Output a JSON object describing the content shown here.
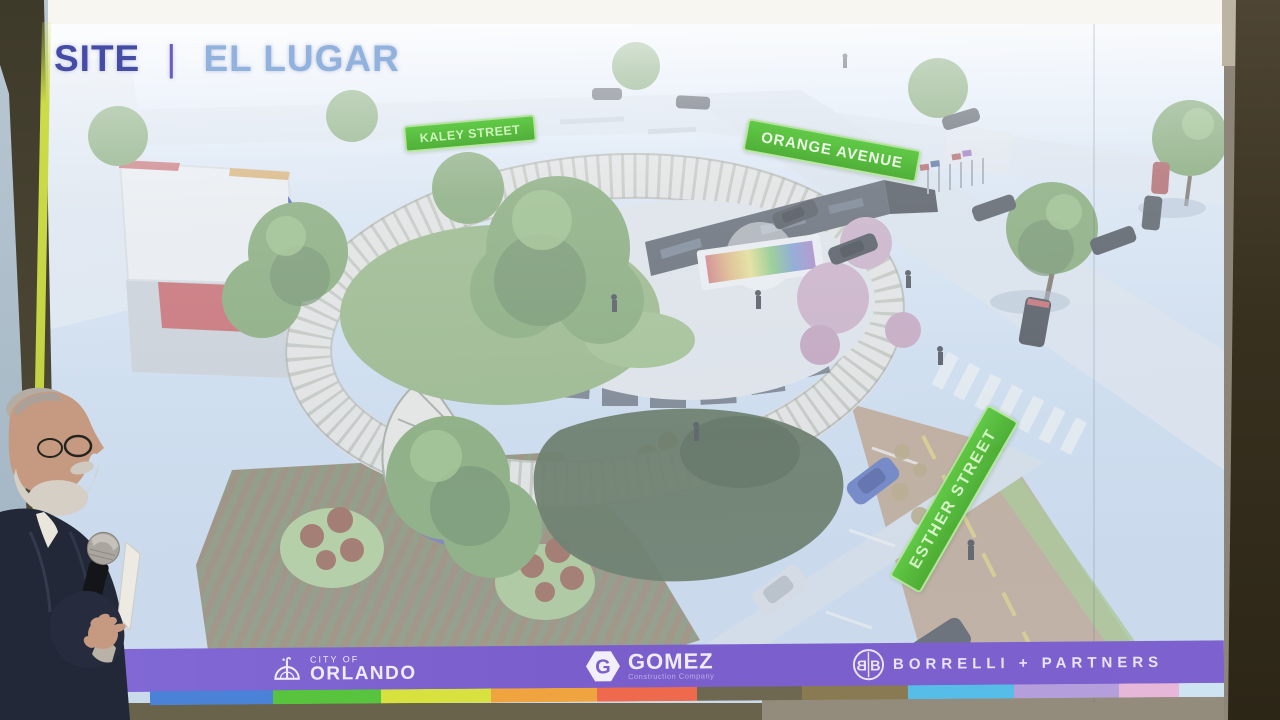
{
  "slide": {
    "title": {
      "section": "SITE",
      "separator": "|",
      "name": "EL LUGAR"
    },
    "street_labels": {
      "kaley": "KALEY STREET",
      "orange": "ORANGE AVENUE",
      "esther": "ESTHER STREET"
    },
    "footer": {
      "orlando_line1": "CITY OF",
      "orlando_line2": "ORLANDO",
      "gomez_initial": "G",
      "gomez_name": "GOMEZ",
      "gomez_tagline": "Construction Company",
      "borrelli_name": "BORRELLI + PARTNERS",
      "bar_color": "#7b5fd0"
    },
    "colors": {
      "street_label_green": "#54c23a",
      "title_site_blue": "#454ca6",
      "title_name_blue": "#90b2dd",
      "screen_edge_strip": "#c3d544"
    },
    "rainbow_segments": [
      {
        "color": "#4a82d8",
        "width": 123
      },
      {
        "color": "#58c43e",
        "width": 108
      },
      {
        "color": "#d8e23e",
        "width": 110
      },
      {
        "color": "#f0a440",
        "width": 106
      },
      {
        "color": "#ef6a4d",
        "width": 100
      },
      {
        "color": "#6e6850",
        "width": 105
      },
      {
        "color": "#8a7a52",
        "width": 106
      },
      {
        "color": "#56bce8",
        "width": 106
      },
      {
        "color": "#b49fdc",
        "width": 105
      },
      {
        "color": "#e6b7d9",
        "width": 60
      },
      {
        "color": "#cfe4f2",
        "width": 45
      }
    ]
  }
}
